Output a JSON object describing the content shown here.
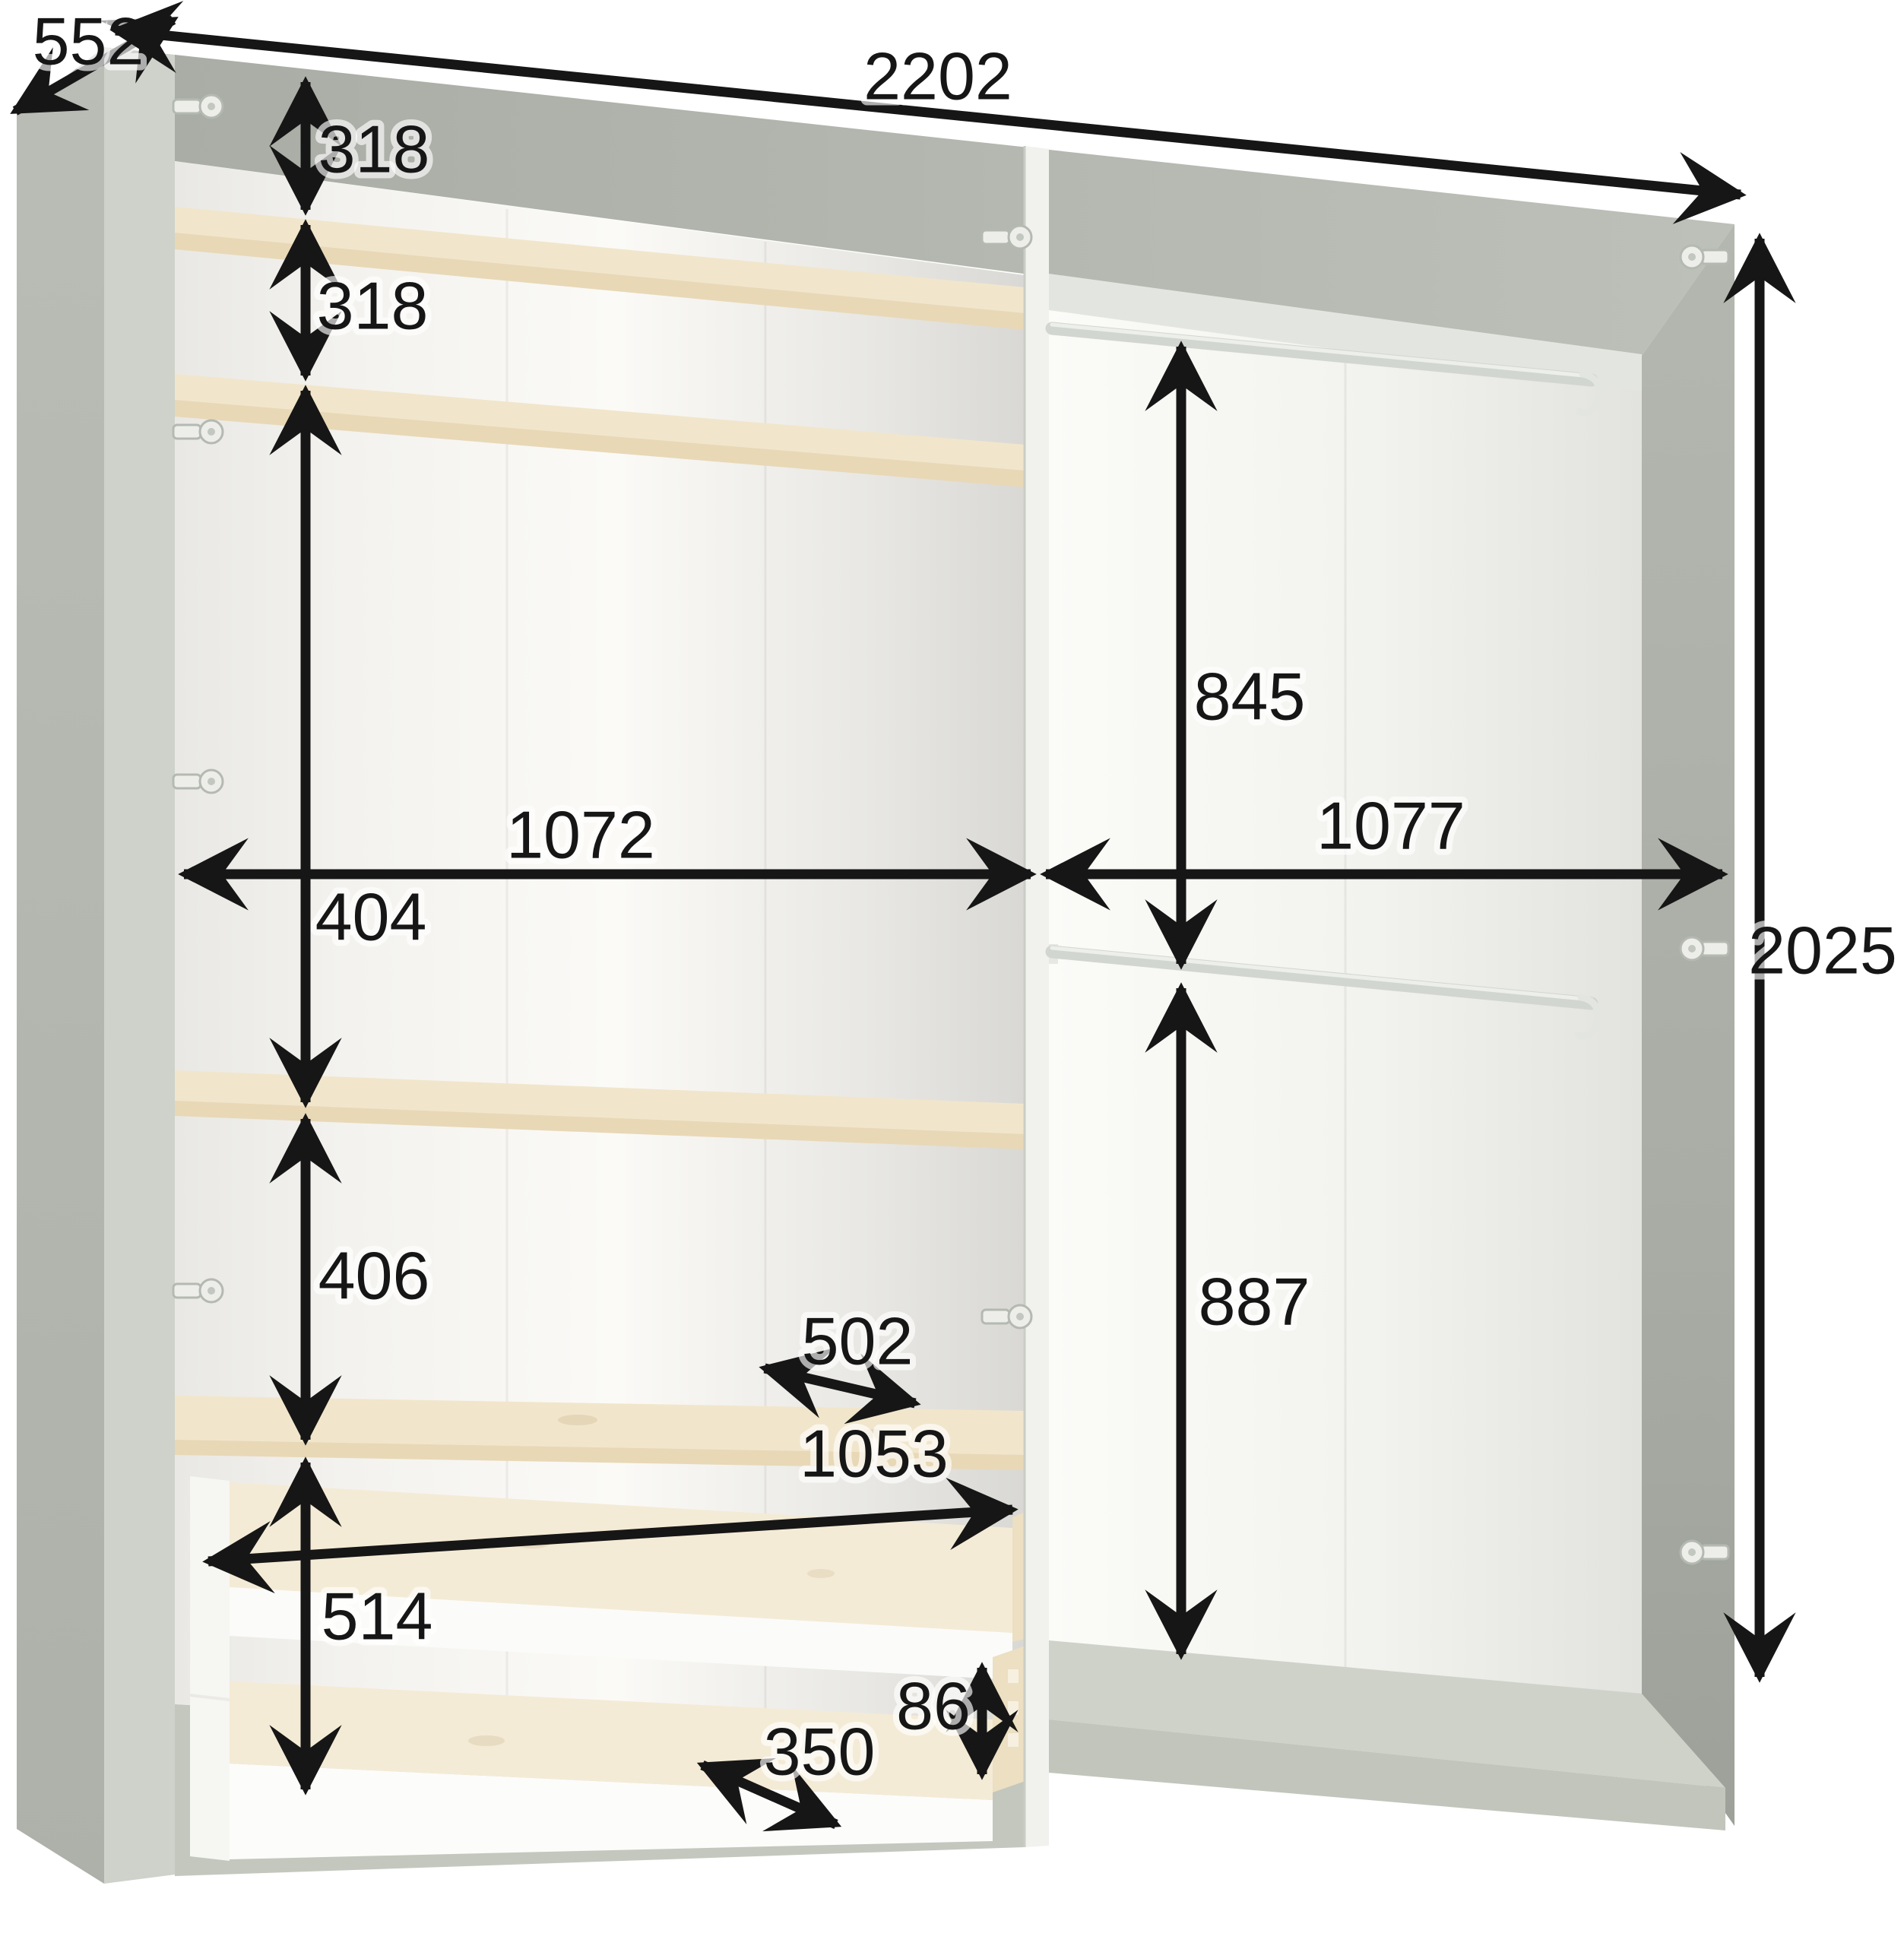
{
  "diagram": {
    "type": "furniture-dimension-diagram",
    "subject": "two-section wardrobe interior, left section with shelves and drawers, right section with hanging rails",
    "units": "mm",
    "view": "three-quarter perspective, open cabinet without doors",
    "palette": {
      "background": "#ffffff",
      "cabinet_gray": "#b6bab2",
      "cabinet_gray_dark": "#a0a49c",
      "interior_white": "#f7f6f3",
      "wood_light_oak": "#f1e6cb",
      "wood_edge": "#e8d8b6",
      "base_gray": "#c3c7bd",
      "hardware_light": "#edeeea",
      "dimension_black": "#161616"
    },
    "components": {
      "sections": 2,
      "shelves": 4,
      "drawers": 2,
      "hanging_rails": 2,
      "rail_hooks": 2,
      "hinges": 9
    },
    "dims": {
      "depth_top": {
        "value": "552",
        "axis": "depth",
        "description": "overall depth along top left edge"
      },
      "width_top": {
        "value": "2202",
        "axis": "width",
        "description": "overall width along top front edge"
      },
      "height_2025": {
        "value": "2025",
        "axis": "height",
        "description": "overall height, right side"
      },
      "gap_318_a": {
        "value": "318",
        "axis": "height",
        "description": "top panel to first shelf"
      },
      "gap_318_b": {
        "value": "318",
        "axis": "height",
        "description": "first shelf to second shelf"
      },
      "gap_404": {
        "value": "404",
        "axis": "height",
        "description": "second shelf to third shelf"
      },
      "gap_406": {
        "value": "406",
        "axis": "height",
        "description": "third shelf to thick shelf above drawers"
      },
      "drawer_zone_514": {
        "value": "514",
        "axis": "height",
        "description": "drawer compartment height below thick shelf"
      },
      "width_left_1072": {
        "value": "1072",
        "axis": "width",
        "description": "left section inner width"
      },
      "width_right_1077": {
        "value": "1077",
        "axis": "width",
        "description": "right section inner width"
      },
      "rail_845": {
        "value": "845",
        "axis": "height",
        "description": "upper hanging space, top rail to lower rail"
      },
      "rail_887": {
        "value": "887",
        "axis": "height",
        "description": "lower hanging space, lower rail to base"
      },
      "shelf_depth_502": {
        "value": "502",
        "axis": "depth",
        "description": "shelf depth"
      },
      "drawer_width_1053": {
        "value": "1053",
        "axis": "width",
        "description": "drawer inner width"
      },
      "drawer_depth_350": {
        "value": "350",
        "axis": "depth",
        "description": "drawer inner depth"
      },
      "drawer_side_86": {
        "value": "86",
        "axis": "height",
        "description": "drawer side panel height"
      }
    }
  }
}
